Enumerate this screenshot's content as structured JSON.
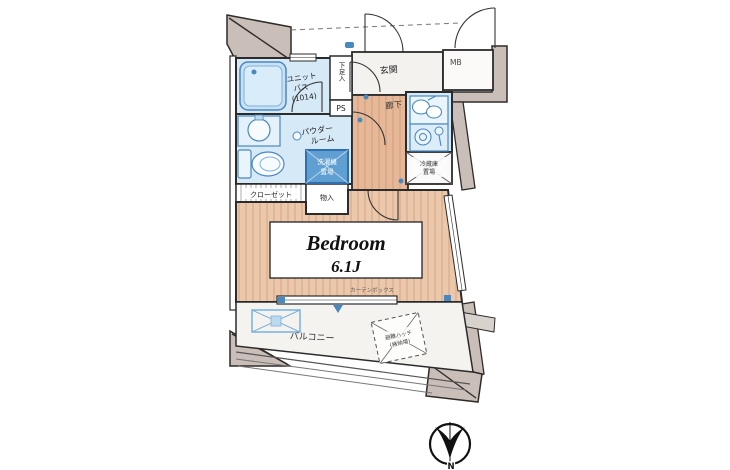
{
  "floorplan": {
    "labels": {
      "unit_bath_1": "ユニット",
      "unit_bath_2": "バス",
      "unit_bath_3": "(1014)",
      "shoe_box": "下足入",
      "ps": "PS",
      "entrance": "玄関",
      "mb": "MB",
      "hallway": "廊下",
      "powder_1": "パウダー",
      "powder_2": "ルーム",
      "washer_1": "洗濯機",
      "washer_2": "置場",
      "closet": "クローゼット",
      "storage": "物入",
      "fridge_1": "冷蔵庫",
      "fridge_2": "置場",
      "bedroom_name": "Bedroom",
      "bedroom_size": "6.1J",
      "curtain_box": "カーテンボックス",
      "balcony": "バルコニー",
      "hatch_1": "避難ハッチ",
      "hatch_2": "(格納場)",
      "north": "N"
    },
    "colors": {
      "accent_blue": "#4a88c0",
      "wet_area": "#d6e9f7",
      "wood": "#ecc8ab",
      "wall_gray": "#c9beb8",
      "washer_box": "#5f9fd2"
    }
  }
}
